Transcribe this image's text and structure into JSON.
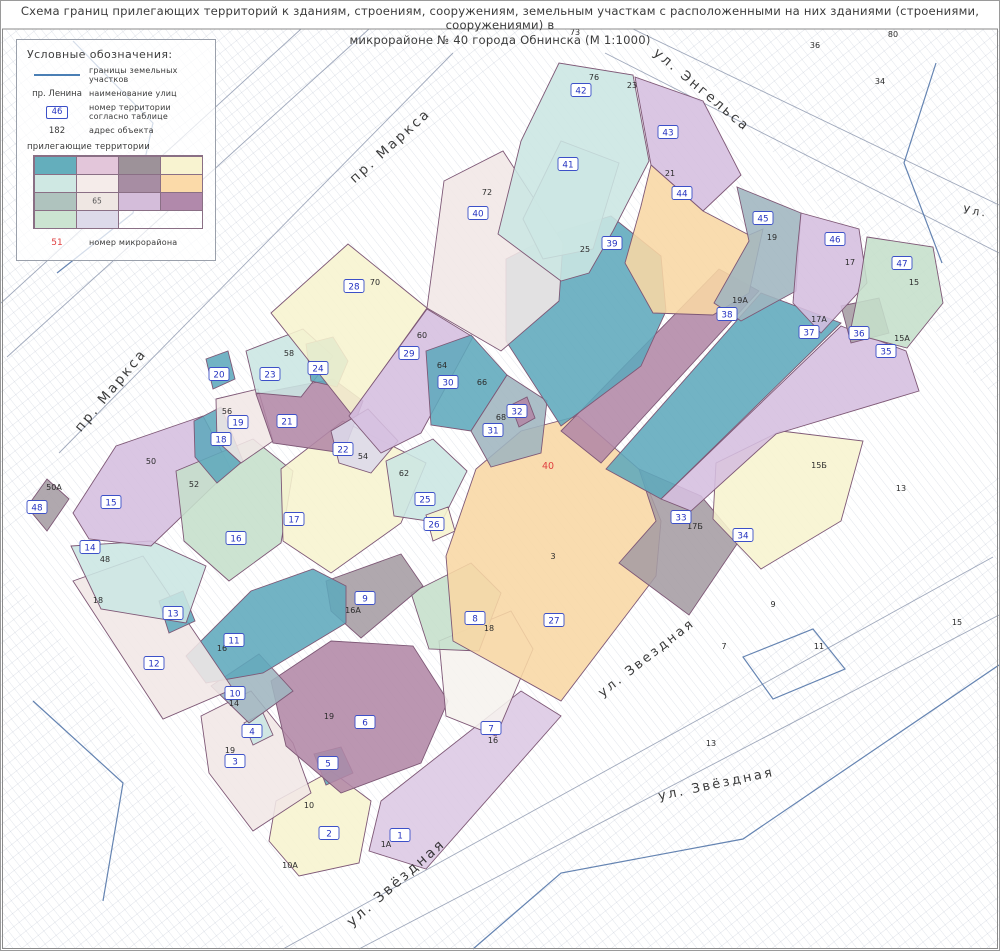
{
  "title": {
    "line1": "Схема границ прилегающих территорий к зданиям, строениям, сооружениям, земельным участкам с расположенными на них зданиями (строениями, сооружениями) в",
    "line2": "микрорайоне № 40  города Обнинска (М 1:1000)"
  },
  "legend": {
    "heading": "Условные обозначения:",
    "boundary": {
      "label": "границы земельных участков"
    },
    "street": {
      "example": "пр. Ленина",
      "label": "наименование улиц"
    },
    "territory_number": {
      "example": "46",
      "label": "номер территории согласно таблице"
    },
    "address": {
      "example": "182",
      "label": "адрес объекта"
    },
    "adjacent_label": "прилегающие территории",
    "swatches": [
      "#64AEBC",
      "#E3C6DA",
      "#9D9299",
      "#F8F3D0",
      "#CFE8E3",
      "#F5ECEA",
      "#A78DA3",
      "#FBDAA9",
      "#AFC3BE",
      "#EFE7E3",
      "#D4BDDA",
      "#B189AB",
      "#CBE4D1",
      "#DDDAEA"
    ],
    "swatch_note": "65",
    "swatch_note_index": 9,
    "district": {
      "example": "51",
      "label": "номер микрорайона"
    }
  },
  "map": {
    "accent_border": "#7E5876",
    "badge_border": "#3C50C8",
    "badge_text": "#2533C0",
    "red": "#E04040",
    "palette": {
      "teal": "#5FA8BC",
      "cyan": "#CBE6E2",
      "cyan2": "#DAEDE8",
      "purple": "#D5BEDF",
      "lavender": "#DCC8E4",
      "lavgray": "#DCD9EA",
      "orange": "#F8D7A4",
      "yellow": "#F7F4CF",
      "green": "#C5DFCB",
      "grayblue": "#9FB5BF",
      "gray": "#A59CA3",
      "mauve": "#B287A6",
      "pink": "#F1E7E6",
      "white2": "#F6F2EE"
    },
    "crosshatch": [
      "0,28 540,28 0,540",
      "660,28 998,28 998,400",
      "998,470 998,948 400,948",
      "0,560 300,948 0,948"
    ],
    "deco": [
      {
        "d": "M300,28 L0,302",
        "c": "g"
      },
      {
        "d": "M368,28 L6,356",
        "c": "g"
      },
      {
        "d": "M452,52 L58,452",
        "c": "g"
      },
      {
        "d": "M632,28 L998,204",
        "c": "g"
      },
      {
        "d": "M604,52 L998,252",
        "c": "g"
      },
      {
        "d": "M282,948 L992,556",
        "c": "g"
      },
      {
        "d": "M358,948 L998,614",
        "c": "g"
      },
      {
        "d": "M72,40 L152,122 L132,212 L56,272",
        "c": "b"
      },
      {
        "d": "M935,62 L903,162 L941,262",
        "c": "b"
      },
      {
        "d": "M32,700 L122,782 L102,900",
        "c": "b"
      },
      {
        "d": "M472,948 L560,872 L742,838 L998,664",
        "c": "b"
      },
      {
        "d": "M742,656 L812,628 L844,668 L772,698 Z",
        "c": "b"
      }
    ],
    "territories": [
      {
        "n": 1,
        "color": "lavender",
        "pts": "380,800 520,690 560,715 425,868 368,850",
        "nx": 399,
        "ny": 834
      },
      {
        "n": 2,
        "color": "yellow",
        "pts": "275,800 330,770 370,800 358,862 298,875 268,840",
        "nx": 328,
        "ny": 832
      },
      {
        "n": 3,
        "color": "pink",
        "pts": "200,715 250,690 292,742 310,792 252,830 208,772",
        "nx": 234,
        "ny": 760
      },
      {
        "n": 4,
        "color": "cyan",
        "pts": "243,722 262,712 272,734 252,744",
        "nx": 251,
        "ny": 730
      },
      {
        "n": 5,
        "color": "teal",
        "pts": "313,753 340,746 352,772 325,784",
        "nx": 327,
        "ny": 762
      },
      {
        "n": 6,
        "color": "mauve",
        "pts": "270,680 330,640 412,645 447,700 420,762 340,792 285,745",
        "nx": 364,
        "ny": 721
      },
      {
        "n": 7,
        "color": "white2",
        "pts": "438,640 510,610 532,648 495,735 445,715",
        "nx": 490,
        "ny": 727
      },
      {
        "n": 8,
        "color": "green",
        "pts": "410,592 470,562 500,592 478,650 428,648",
        "nx": 474,
        "ny": 617
      },
      {
        "n": 9,
        "color": "gray",
        "pts": "325,580 400,553 422,585 360,637 330,610",
        "nx": 364,
        "ny": 597
      },
      {
        "n": 10,
        "color": "grayblue",
        "pts": "210,685 258,653 292,690 248,722",
        "nx": 234,
        "ny": 692
      },
      {
        "n": 11,
        "color": "teal",
        "pts": "185,655 250,590 312,568 345,585 345,622 262,672 205,682",
        "nx": 233,
        "ny": 639
      },
      {
        "n": 12,
        "color": "pink",
        "pts": "72,580 142,555 232,688 162,718",
        "nx": 153,
        "ny": 662
      },
      {
        "n": 13,
        "color": "teal",
        "pts": "158,600 182,590 194,620 168,632",
        "nx": 172,
        "ny": 612
      },
      {
        "n": 14,
        "color": "cyan",
        "pts": "70,545 150,540 205,565 185,622 100,608",
        "nx": 89,
        "ny": 546
      },
      {
        "n": 15,
        "color": "purple",
        "pts": "72,512 115,445 202,415 230,468 150,545 88,538",
        "nx": 110,
        "ny": 501
      },
      {
        "n": 16,
        "color": "green",
        "pts": "175,470 252,438 292,470 280,542 228,580 183,540",
        "nx": 235,
        "ny": 537
      },
      {
        "n": 17,
        "color": "yellow",
        "pts": "280,468 342,420 425,462 400,522 330,572 282,540",
        "nx": 293,
        "ny": 518
      },
      {
        "n": 18,
        "color": "teal",
        "pts": "193,420 220,406 242,460 216,482 194,456",
        "nx": 220,
        "ny": 438
      },
      {
        "n": 19,
        "color": "pink",
        "pts": "215,398 257,388 272,440 240,462 216,440",
        "nx": 237,
        "ny": 421
      },
      {
        "n": 20,
        "color": "teal",
        "pts": "205,358 227,350 234,378 212,388",
        "nx": 218,
        "ny": 373
      },
      {
        "n": 21,
        "color": "mauve",
        "pts": "255,393 332,378 362,400 342,452 272,442",
        "nx": 286,
        "ny": 420
      },
      {
        "n": 22,
        "color": "lavgray",
        "pts": "330,430 367,408 397,440 370,472 338,462",
        "nx": 342,
        "ny": 448
      },
      {
        "n": 23,
        "color": "cyan",
        "pts": "245,350 302,328 332,355 300,396 255,392",
        "nx": 269,
        "ny": 373
      },
      {
        "n": 24,
        "color": "teal",
        "pts": "305,343 332,336 347,360 336,386 310,380",
        "nx": 317,
        "ny": 367
      },
      {
        "n": 25,
        "color": "cyan",
        "pts": "385,460 432,438 466,470 440,522 393,515",
        "nx": 424,
        "ny": 498
      },
      {
        "n": 26,
        "color": "yellow",
        "pts": "425,514 447,506 454,530 432,540",
        "nx": 433,
        "ny": 523
      },
      {
        "n": 27,
        "color": "orange",
        "pts": "445,555 475,468 520,430 577,415 640,470 660,520 655,575 560,700 452,640",
        "nx": 553,
        "ny": 619
      },
      {
        "n": 28,
        "color": "yellow",
        "pts": "270,312 347,243 426,307 350,413",
        "nx": 353,
        "ny": 285
      },
      {
        "n": 29,
        "color": "purple",
        "pts": "348,415 426,308 472,336 420,432 380,452",
        "nx": 408,
        "ny": 352
      },
      {
        "n": 30,
        "color": "teal",
        "pts": "425,350 470,334 506,374 470,430 430,424",
        "nx": 447,
        "ny": 381
      },
      {
        "n": 31,
        "color": "grayblue",
        "pts": "470,430 506,374 546,400 540,452 490,466",
        "nx": 492,
        "ny": 429
      },
      {
        "n": 32,
        "color": "mauve",
        "pts": "510,404 526,396 534,417 518,426",
        "nx": 516,
        "ny": 410
      },
      {
        "n": 33,
        "color": "gray",
        "pts": "638,468 700,495 738,540 688,614 618,562 655,520",
        "nx": 680,
        "ny": 516
      },
      {
        "n": 34,
        "color": "yellow",
        "pts": "715,462 780,430 862,440 840,520 760,568 712,518",
        "nx": 742,
        "ny": 534
      },
      {
        "n": 35,
        "color": "purple",
        "pts": "660,498 840,325 905,350 918,390 775,433 690,510",
        "nx": 885,
        "ny": 350
      },
      {
        "n": 36,
        "color": "gray",
        "pts": "840,305 878,297 888,332 850,342",
        "nx": 858,
        "ny": 332
      },
      {
        "n": 37,
        "color": "teal",
        "pts": "605,468 760,292 840,322 660,498",
        "nx": 808,
        "ny": 331
      },
      {
        "n": 38,
        "color": "mauve",
        "pts": "560,430 718,268 758,290 600,462",
        "nx": 726,
        "ny": 313
      },
      {
        "n": 39,
        "color": "teal",
        "pts": "505,258 560,230 610,215 660,255 665,310 640,365 560,425 505,340",
        "nx": 611,
        "ny": 242
      },
      {
        "n": 40,
        "color": "pink",
        "pts": "435,240 443,180 502,150 562,242 558,300 500,350 426,307",
        "nx": 477,
        "ny": 212
      },
      {
        "n": 41,
        "color": "cyan2",
        "pts": "522,218 560,140 618,162 592,248 542,258",
        "nx": 567,
        "ny": 163
      },
      {
        "n": 42,
        "color": "cyan",
        "pts": "497,233 520,140 558,62 632,74 648,160 612,230 588,272 560,280",
        "nx": 580,
        "ny": 89
      },
      {
        "n": 43,
        "color": "purple",
        "pts": "634,76 702,100 740,174 702,210 650,164",
        "nx": 667,
        "ny": 131
      },
      {
        "n": 44,
        "color": "orange",
        "pts": "650,164 702,210 748,234 762,228 748,292 712,314 652,312 624,262 640,205",
        "nx": 681,
        "ny": 192
      },
      {
        "n": 45,
        "color": "grayblue",
        "pts": "736,186 800,212 795,290 740,320 713,302 748,240",
        "nx": 762,
        "ny": 217
      },
      {
        "n": 46,
        "color": "purple",
        "pts": "800,212 858,228 866,282 820,332 792,302 796,252",
        "nx": 834,
        "ny": 238
      },
      {
        "n": 47,
        "color": "green",
        "pts": "866,236 932,246 942,302 906,347 849,332 859,282",
        "nx": 901,
        "ny": 262
      },
      {
        "n": 48,
        "color": "gray",
        "pts": "26,506 46,478 68,498 46,530",
        "nx": 36,
        "ny": 506
      }
    ],
    "addresses": [
      {
        "t": "76",
        "x": 593,
        "y": 79
      },
      {
        "t": "23",
        "x": 631,
        "y": 87
      },
      {
        "t": "72",
        "x": 486,
        "y": 194
      },
      {
        "t": "21",
        "x": 669,
        "y": 175
      },
      {
        "t": "25",
        "x": 584,
        "y": 251
      },
      {
        "t": "19",
        "x": 771,
        "y": 239
      },
      {
        "t": "17",
        "x": 849,
        "y": 264
      },
      {
        "t": "15",
        "x": 913,
        "y": 284
      },
      {
        "t": "70",
        "x": 374,
        "y": 284
      },
      {
        "t": "60",
        "x": 421,
        "y": 337
      },
      {
        "t": "19А",
        "x": 739,
        "y": 302
      },
      {
        "t": "17А",
        "x": 818,
        "y": 321
      },
      {
        "t": "15А",
        "x": 901,
        "y": 340
      },
      {
        "t": "58",
        "x": 288,
        "y": 355
      },
      {
        "t": "64",
        "x": 441,
        "y": 367
      },
      {
        "t": "66",
        "x": 481,
        "y": 384
      },
      {
        "t": "56",
        "x": 226,
        "y": 413
      },
      {
        "t": "68",
        "x": 500,
        "y": 419
      },
      {
        "t": "54",
        "x": 362,
        "y": 458
      },
      {
        "t": "50",
        "x": 150,
        "y": 463
      },
      {
        "t": "15Б",
        "x": 818,
        "y": 467
      },
      {
        "t": "62",
        "x": 403,
        "y": 475
      },
      {
        "t": "52",
        "x": 193,
        "y": 486
      },
      {
        "t": "17Б",
        "x": 694,
        "y": 528
      },
      {
        "t": "3",
        "x": 552,
        "y": 558
      },
      {
        "t": "48",
        "x": 104,
        "y": 561
      },
      {
        "t": "18",
        "x": 97,
        "y": 602
      },
      {
        "t": "16А",
        "x": 352,
        "y": 612
      },
      {
        "t": "18",
        "x": 488,
        "y": 630
      },
      {
        "t": "16",
        "x": 221,
        "y": 650
      },
      {
        "t": "14",
        "x": 233,
        "y": 705
      },
      {
        "t": "19",
        "x": 328,
        "y": 718
      },
      {
        "t": "19",
        "x": 229,
        "y": 752
      },
      {
        "t": "16",
        "x": 492,
        "y": 742
      },
      {
        "t": "10",
        "x": 308,
        "y": 807
      },
      {
        "t": "1А",
        "x": 385,
        "y": 846
      },
      {
        "t": "10А",
        "x": 289,
        "y": 867
      },
      {
        "t": "50А",
        "x": 53,
        "y": 489
      },
      {
        "t": "73",
        "x": 574,
        "y": 34
      },
      {
        "t": "80",
        "x": 892,
        "y": 36
      },
      {
        "t": "36",
        "x": 814,
        "y": 47
      },
      {
        "t": "34",
        "x": 879,
        "y": 83
      },
      {
        "t": "13",
        "x": 900,
        "y": 490
      },
      {
        "t": "9",
        "x": 772,
        "y": 606
      },
      {
        "t": "7",
        "x": 723,
        "y": 648
      },
      {
        "t": "11",
        "x": 818,
        "y": 648
      },
      {
        "t": "13",
        "x": 710,
        "y": 745
      },
      {
        "t": "15",
        "x": 956,
        "y": 624
      }
    ],
    "streets": [
      {
        "text": "пр. Маркса",
        "x": 392,
        "y": 148,
        "rot": -42,
        "size": 13.5
      },
      {
        "text": "пр. Маркса",
        "x": 113,
        "y": 392,
        "rot": -50,
        "size": 13.5
      },
      {
        "text": "ул. Энгельса",
        "x": 698,
        "y": 92,
        "rot": 40,
        "size": 13.5
      },
      {
        "text": "Ул.",
        "x": 974,
        "y": 214,
        "rot": 8,
        "size": 11
      },
      {
        "text": "ул. Звездная",
        "x": 648,
        "y": 660,
        "rot": -38,
        "size": 13
      },
      {
        "text": "ул. Звёздная",
        "x": 716,
        "y": 787,
        "rot": -12,
        "size": 13
      },
      {
        "text": "ул. Звёздная",
        "x": 398,
        "y": 885,
        "rot": -41,
        "size": 14
      }
    ],
    "district_number": {
      "value": "40",
      "x": 547,
      "y": 468
    }
  }
}
